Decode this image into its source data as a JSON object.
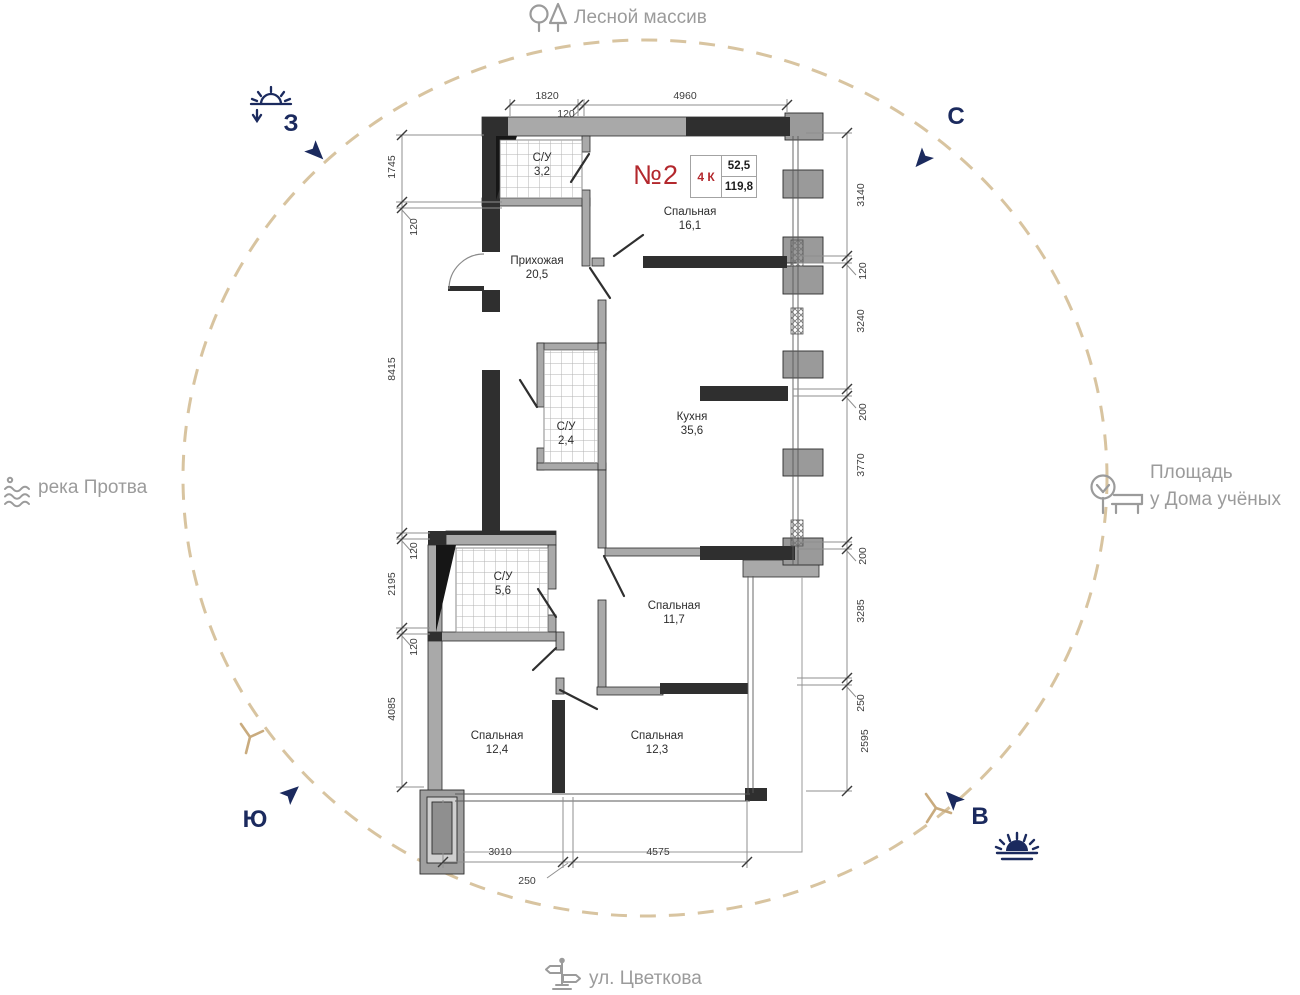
{
  "unit": {
    "number": "№2",
    "type": "4 К",
    "living_area": "52,5",
    "total_area": "119,8"
  },
  "rooms": [
    {
      "name": "С/У",
      "area": "3,2"
    },
    {
      "name": "Спальная",
      "area": "16,1"
    },
    {
      "name": "Прихожая",
      "area": "20,5"
    },
    {
      "name": "С/У",
      "area": "2,4"
    },
    {
      "name": "Кухня",
      "area": "35,6"
    },
    {
      "name": "С/У",
      "area": "5,6"
    },
    {
      "name": "Спальная",
      "area": "11,7"
    },
    {
      "name": "Спальная",
      "area": "12,4"
    },
    {
      "name": "Спальная",
      "area": "12,3"
    }
  ],
  "dimensions": {
    "top": [
      "1820",
      "120",
      "4960"
    ],
    "left": [
      "1745",
      "120",
      "8415",
      "120",
      "2195",
      "120",
      "4085"
    ],
    "right": [
      "3140",
      "120",
      "3240",
      "200",
      "3770",
      "200",
      "3285",
      "250",
      "2595"
    ],
    "bottom": [
      "3010",
      "250",
      "4575"
    ]
  },
  "compass": {
    "west": "З",
    "north": "С",
    "south": "Ю",
    "east": "В"
  },
  "landmarks": {
    "north": "Лесной массив",
    "west": "река Протва",
    "east_line1": "Площадь",
    "east_line2": "у Дома учёных",
    "south": "ул. Цветкова"
  },
  "colors": {
    "accent_red": "#b3282d",
    "navy": "#1b2a5e",
    "circle_tan": "#d8c4a0",
    "label_gray": "#9b9b9b"
  }
}
